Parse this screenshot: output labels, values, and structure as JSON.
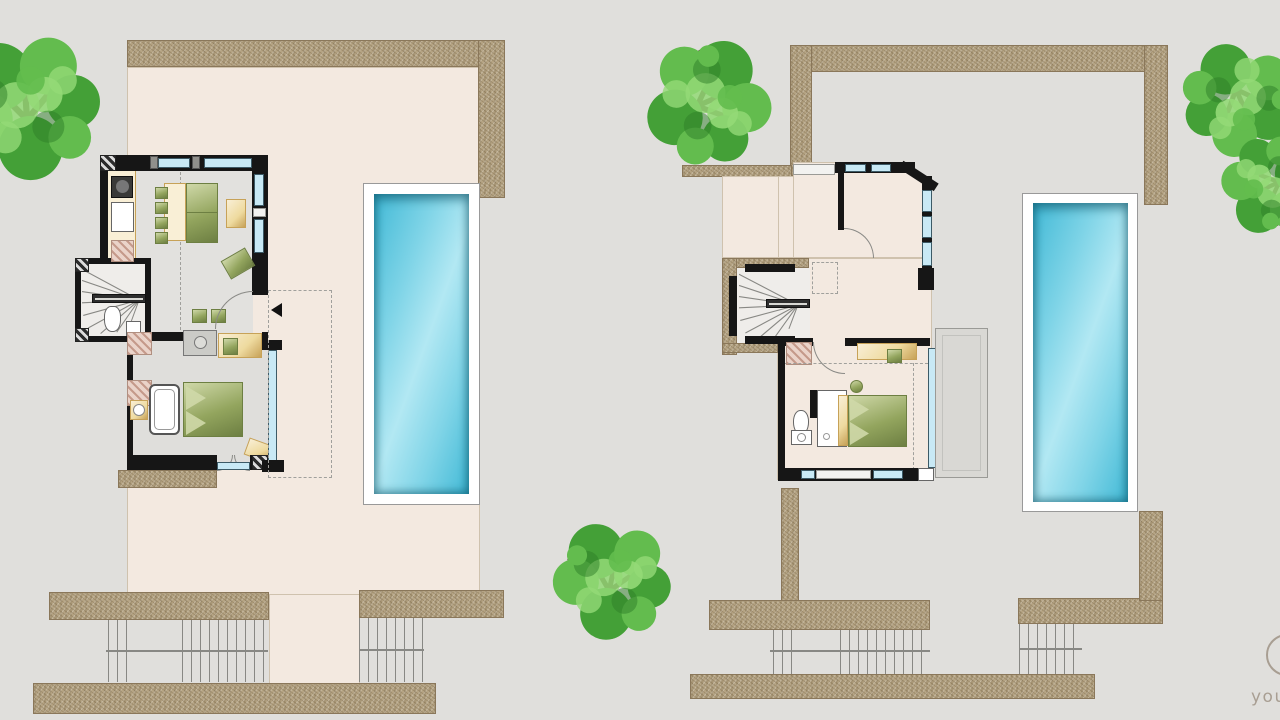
{
  "watermark": {
    "text": "you"
  },
  "palette": {
    "bg": "#e0dfdc",
    "stone": "#b5a484",
    "stoneedge": "#8a775a",
    "cream": "#f3e9e0",
    "creamline": "#cfc2ae",
    "wall": "#161616",
    "gray": "#9a9a96",
    "window": "#c8e9f5",
    "windowline": "#3c5a66",
    "sill": "#f2f2f0",
    "waterdeep": "#41b9d6",
    "watermid": "#7fd4e7",
    "waterlight": "#b2e8f3",
    "green": "#93a55e",
    "greendark": "#6d7f42",
    "greenlight": "#cfd8a8",
    "wood": "#eeda9f",
    "woodlight": "#f9efd6",
    "woodedge": "#c7a258",
    "floor": "#e2e1de",
    "floorbed": "#dfdedb",
    "stairfloor": "#efedea",
    "pink": "#ead3c9",
    "steps": "#888884",
    "dash": "#a0a09c",
    "balcony": "#d9d8d4",
    "treedark": "#4a3a26",
    "tree1": "#44a037",
    "tree2": "#63bc4e",
    "tree3": "#93d977",
    "tree4": "#2e7d27",
    "watermark": "#a89e92",
    "white": "#ffffff"
  }
}
